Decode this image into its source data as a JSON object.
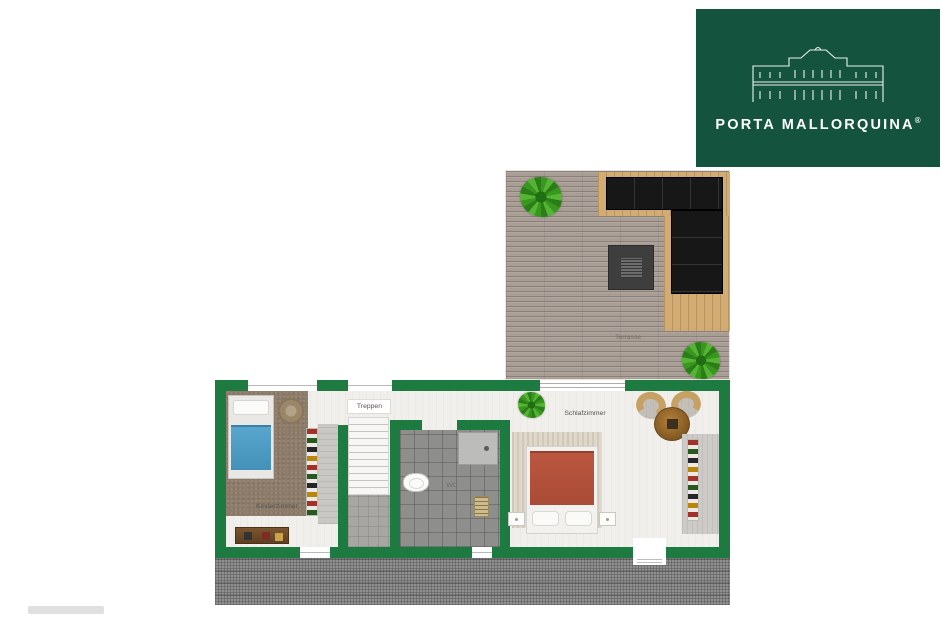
{
  "logo": {
    "brand": "PORTA MALLORQUINA",
    "registered_mark": "®",
    "background_color": "#14543e",
    "icon": "finca-facade-icon"
  },
  "rooms": {
    "kinderzimmer": "Kinderzimmer",
    "treppen": "Treppen",
    "wc": "WC",
    "schlafzimmer": "Schlafzimmer",
    "terrasse": "Terrasse"
  },
  "colors": {
    "wall": "#1d7b41",
    "logo_background": "#14543e",
    "terrace_decking": "#a99e96",
    "deck_wood": "#d2ac72",
    "sofa": "#171717",
    "kids_room_carpet": "#8d7c6a",
    "kids_bed_blanket": "#4f9cc4",
    "bathroom_tile": "#8e8e8c",
    "master_bed_cover": "#b2503a",
    "lower_roof_hatch": "#8f8f8f"
  },
  "icons": {
    "logo": "finca-facade-icon",
    "plants": "plant-icon"
  }
}
